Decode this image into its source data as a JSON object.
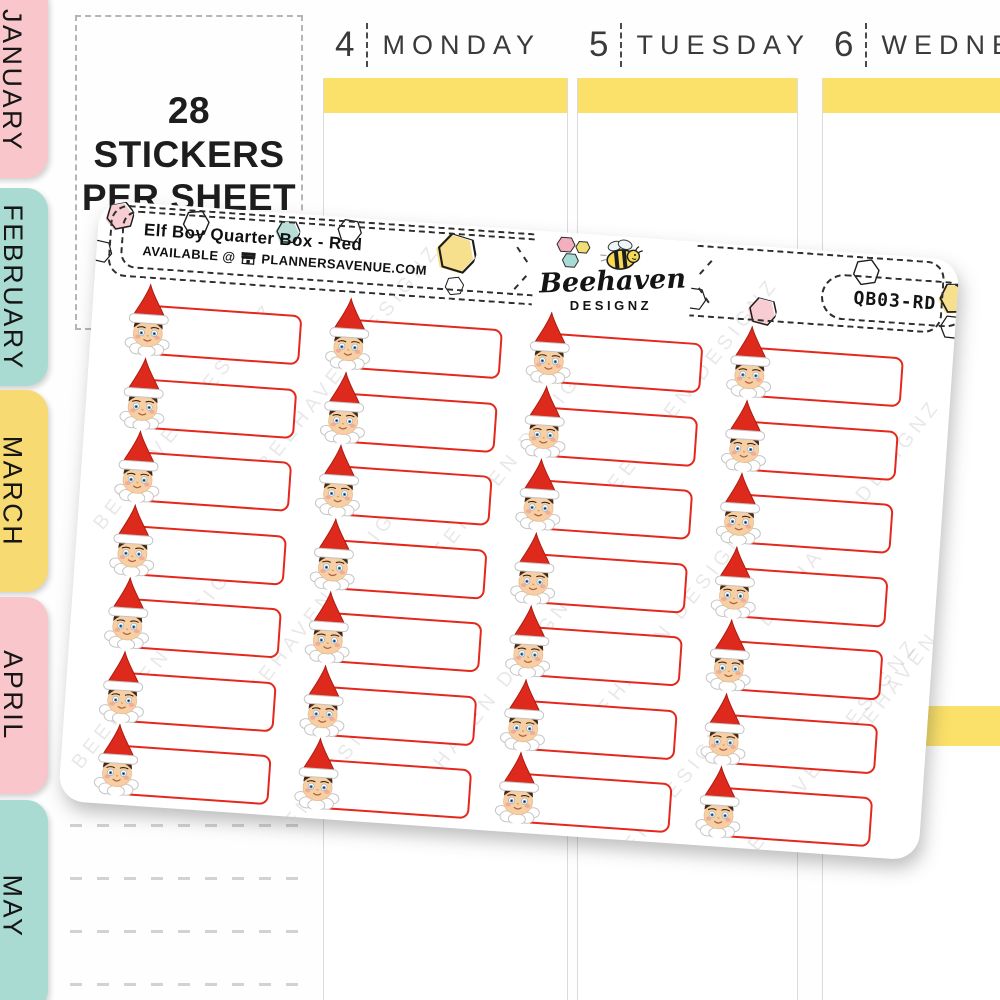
{
  "left_note": {
    "line1": "28 STICKERS",
    "line2": "PER SHEET"
  },
  "tabs": [
    {
      "label": "JANUARY",
      "color": "#f9c7cb"
    },
    {
      "label": "FEBRUARY",
      "color": "#aadbd2"
    },
    {
      "label": "MARCH",
      "color": "#f8da72"
    },
    {
      "label": "APRIL",
      "color": "#f9c7cb"
    },
    {
      "label": "MAY",
      "color": "#a9dbd2"
    }
  ],
  "calendar": {
    "highlight_color": "#fbe169",
    "days": [
      {
        "number": "4",
        "name": "MONDAY"
      },
      {
        "number": "5",
        "name": "TUESDAY"
      },
      {
        "number": "6",
        "name": "WEDNESDAY"
      }
    ]
  },
  "sheet": {
    "title": "Elf Boy Quarter Box - Red",
    "available_label": "AVAILABLE @",
    "site": "PLANNERSAVENUE.COM",
    "brand_script": "Beehaven",
    "brand_sub": "DESIGNZ",
    "sku": "QB03-RD",
    "watermark": "BEEHAVEN DESIGNZ",
    "sticker_count": 28,
    "grid": {
      "rows": 7,
      "cols": 4
    },
    "colors": {
      "box_red": "#e4281c",
      "hat_red": "#dd2a1d",
      "hex_pink": "#f7cdd2",
      "hex_teal": "#b9ded8",
      "hex_yellow": "#f6e08e"
    },
    "icons": {
      "availability": "storefront-icon",
      "brand": [
        "honeycomb-icon",
        "bee-icon"
      ],
      "sticker": "elf-boy-icon"
    }
  }
}
